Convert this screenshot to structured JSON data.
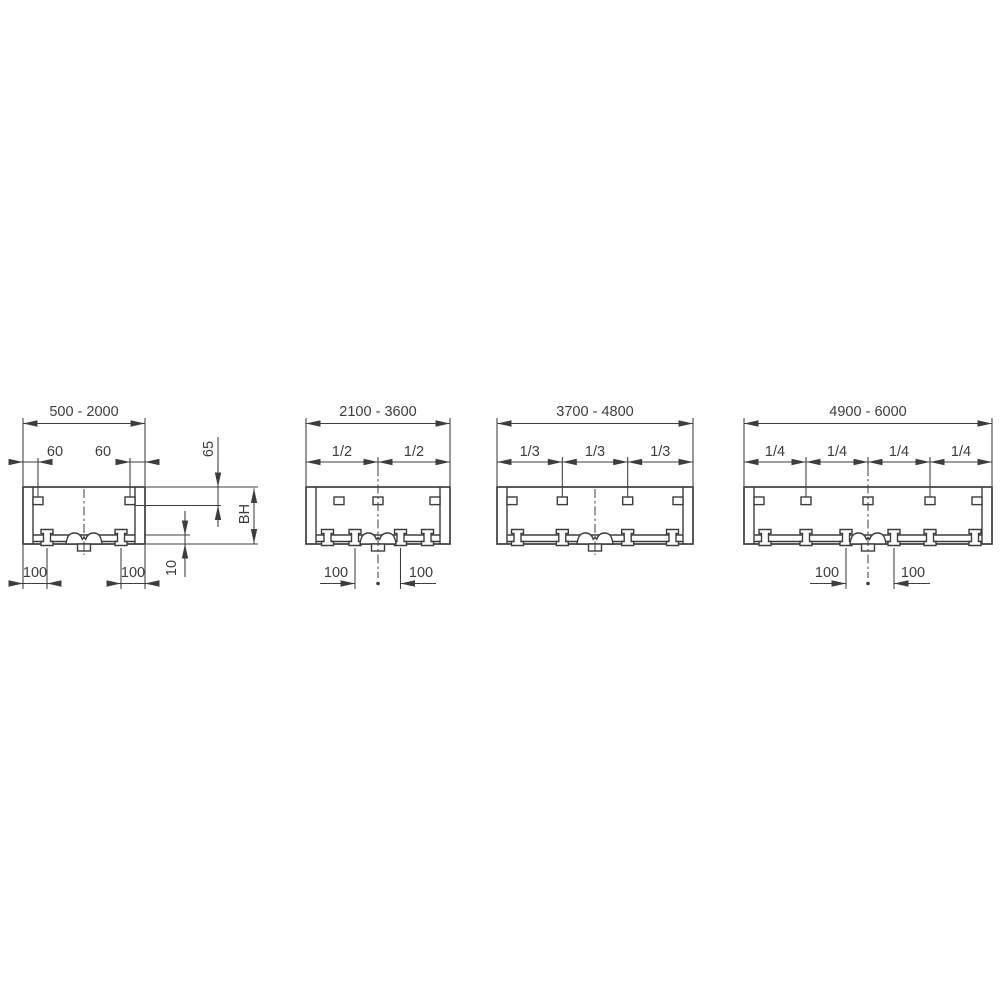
{
  "diagram": {
    "background_color": "#ffffff",
    "line_color": "#3d3d3d",
    "panels": [
      {
        "length_range": "500 - 2000",
        "edge_offset_left": "60",
        "edge_offset_right": "60",
        "height_top": "65",
        "height_label": "BH",
        "height_bottom": "10",
        "clamp_offset_left": "100",
        "clamp_offset_right": "100"
      },
      {
        "length_range": "2100 - 3600",
        "fractions": [
          "1/2",
          "1/2"
        ],
        "clamp_offset_left": "100",
        "clamp_offset_right": "100"
      },
      {
        "length_range": "3700 - 4800",
        "fractions": [
          "1/3",
          "1/3",
          "1/3"
        ]
      },
      {
        "length_range": "4900 - 6000",
        "fractions": [
          "1/4",
          "1/4",
          "1/4",
          "1/4"
        ],
        "clamp_offset_left": "100",
        "clamp_offset_right": "100"
      }
    ]
  }
}
